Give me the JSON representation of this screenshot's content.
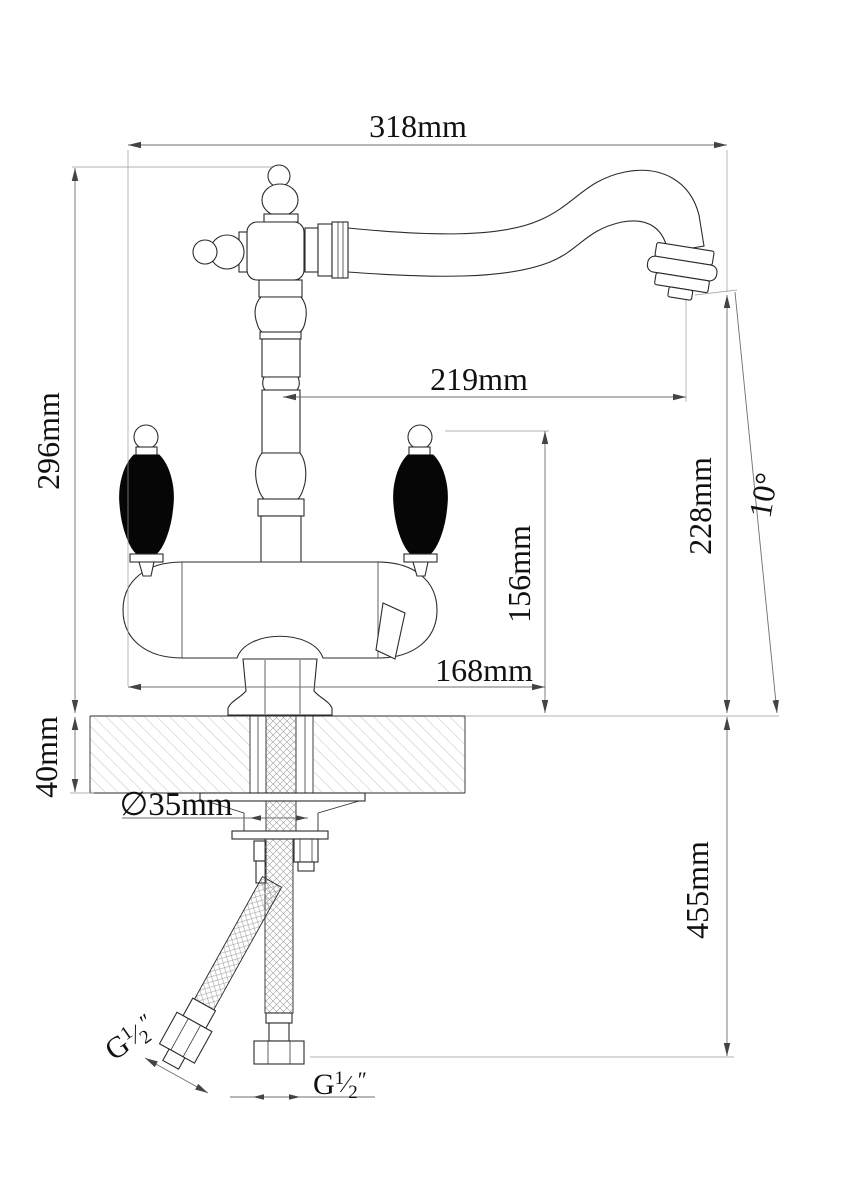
{
  "drawing_type": "faucet-installation-dimension-diagram",
  "dimensions": {
    "overall_width": "318mm",
    "spout_reach": "219mm",
    "body_height": "296mm",
    "outlet_height": "228mm",
    "spout_angle": "10°",
    "handle_height": "156mm",
    "body_width": "168mm",
    "deck_thickness": "40mm",
    "hole_diameter": "∅35mm",
    "hose_length": "455mm"
  },
  "thread": {
    "prefix": "G",
    "numerator": "1",
    "slash": "⁄",
    "denominator": "2",
    "unit": "″"
  },
  "colors": {
    "outline": "#2b2b2b",
    "dimension_line": "#6f6f6f",
    "extension_line": "#9a9a9a",
    "handle_fill": "#060606",
    "background": "#ffffff",
    "hatch": "#a8a8a8"
  }
}
